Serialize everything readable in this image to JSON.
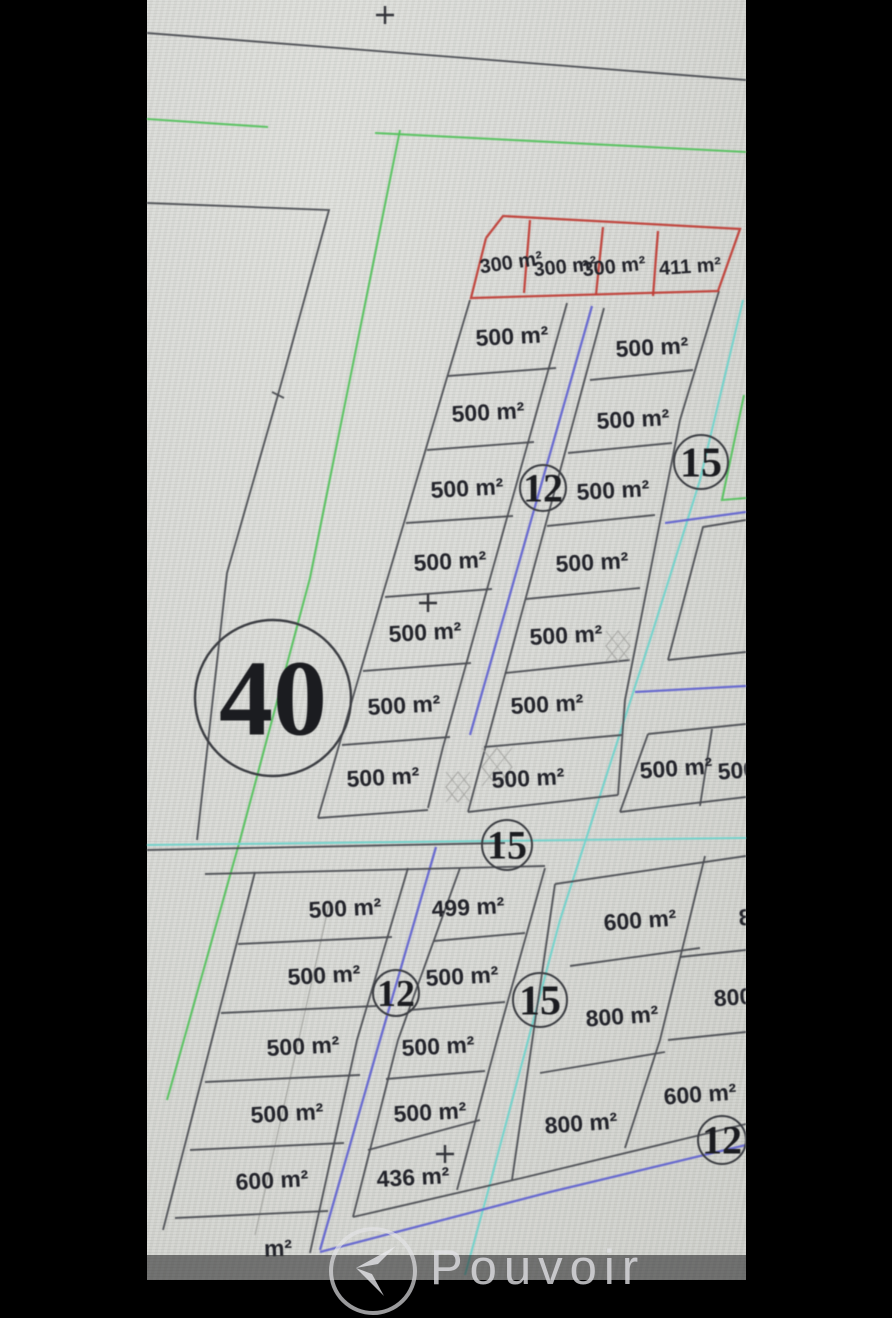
{
  "scene": {
    "width": 892,
    "height": 1280,
    "photo_left": 147,
    "photo_right": 746
  },
  "colors": {
    "screen_bg": "#d6d7d3",
    "line_dark": "#4b4d52",
    "line_red": "#bf3d35",
    "line_green": "#54c15c",
    "line_blue": "#6163cf",
    "line_teal": "#6fd3cb",
    "line_faint": "#a4a5a1",
    "label_ink": "#23242b",
    "circle_stroke": "#3c3e43",
    "watermark_bar": "rgba(32,32,35,0.55)",
    "watermark_ink": "rgba(226,226,229,0.78)"
  },
  "watermark": {
    "brand": "Pouvoir"
  },
  "plot_labels": [
    {
      "text": "300 m²",
      "x": 511,
      "y": 262,
      "rot": -8,
      "size": 20
    },
    {
      "text": "300 m²",
      "x": 565,
      "y": 266,
      "rot": -6,
      "size": 20
    },
    {
      "text": "300 m²",
      "x": 614,
      "y": 266,
      "rot": -6,
      "size": 20
    },
    {
      "text": "411 m²",
      "x": 690,
      "y": 266,
      "rot": -4,
      "size": 20
    },
    {
      "text": "500 m²",
      "x": 512,
      "y": 336,
      "rot": -3,
      "size": 23
    },
    {
      "text": "500 m²",
      "x": 488,
      "y": 412,
      "rot": -3,
      "size": 23
    },
    {
      "text": "500 m²",
      "x": 467,
      "y": 488,
      "rot": -3,
      "size": 23
    },
    {
      "text": "500 m²",
      "x": 450,
      "y": 561,
      "rot": -3,
      "size": 23
    },
    {
      "text": "500 m²",
      "x": 425,
      "y": 632,
      "rot": -3,
      "size": 23
    },
    {
      "text": "500 m²",
      "x": 404,
      "y": 705,
      "rot": -3,
      "size": 23
    },
    {
      "text": "500 m²",
      "x": 383,
      "y": 777,
      "rot": -3,
      "size": 23
    },
    {
      "text": "500 m²",
      "x": 652,
      "y": 347,
      "rot": -3,
      "size": 23
    },
    {
      "text": "500 m²",
      "x": 633,
      "y": 419,
      "rot": -3,
      "size": 23
    },
    {
      "text": "500 m²",
      "x": 613,
      "y": 490,
      "rot": -3,
      "size": 23
    },
    {
      "text": "500 m²",
      "x": 592,
      "y": 562,
      "rot": -3,
      "size": 23
    },
    {
      "text": "500 m²",
      "x": 566,
      "y": 635,
      "rot": -3,
      "size": 23
    },
    {
      "text": "500 m²",
      "x": 547,
      "y": 704,
      "rot": -3,
      "size": 23
    },
    {
      "text": "500 m²",
      "x": 528,
      "y": 778,
      "rot": -3,
      "size": 23
    },
    {
      "text": "500 m²",
      "x": 676,
      "y": 768,
      "rot": -4,
      "size": 23
    },
    {
      "text": "500 m²",
      "x": 754,
      "y": 769,
      "rot": -4,
      "size": 23
    },
    {
      "text": "500 m²",
      "x": 345,
      "y": 908,
      "rot": -3,
      "size": 23
    },
    {
      "text": "500 m²",
      "x": 324,
      "y": 975,
      "rot": -3,
      "size": 23
    },
    {
      "text": "500 m²",
      "x": 303,
      "y": 1046,
      "rot": -3,
      "size": 23
    },
    {
      "text": "500 m²",
      "x": 287,
      "y": 1113,
      "rot": -3,
      "size": 23
    },
    {
      "text": "600 m²",
      "x": 272,
      "y": 1180,
      "rot": -3,
      "size": 23
    },
    {
      "text": "m²",
      "x": 278,
      "y": 1248,
      "rot": -2,
      "size": 23
    },
    {
      "text": "499 m²",
      "x": 468,
      "y": 907,
      "rot": -3,
      "size": 23
    },
    {
      "text": "500 m²",
      "x": 462,
      "y": 976,
      "rot": -3,
      "size": 23
    },
    {
      "text": "500 m²",
      "x": 438,
      "y": 1046,
      "rot": -3,
      "size": 23
    },
    {
      "text": "500 m²",
      "x": 430,
      "y": 1112,
      "rot": -3,
      "size": 23
    },
    {
      "text": "436 m²",
      "x": 413,
      "y": 1177,
      "rot": -3,
      "size": 23
    },
    {
      "text": "600 m²",
      "x": 640,
      "y": 920,
      "rot": -4,
      "size": 23
    },
    {
      "text": "800 m²",
      "x": 622,
      "y": 1016,
      "rot": -4,
      "size": 23
    },
    {
      "text": "800 m²",
      "x": 581,
      "y": 1123,
      "rot": -4,
      "size": 23
    },
    {
      "text": "800 m²",
      "x": 775,
      "y": 915,
      "rot": -4,
      "size": 23
    },
    {
      "text": "800",
      "x": 733,
      "y": 997,
      "rot": -4,
      "size": 23
    },
    {
      "text": "600 m²",
      "x": 700,
      "y": 1094,
      "rot": -4,
      "size": 23
    }
  ],
  "road_circles": [
    {
      "num": "40",
      "x": 273,
      "y": 698,
      "rad": 78,
      "fs": 108
    },
    {
      "num": "12",
      "x": 543,
      "y": 488,
      "rad": 23,
      "fs": 40
    },
    {
      "num": "15",
      "x": 701,
      "y": 462,
      "rad": 27,
      "fs": 42
    },
    {
      "num": "15",
      "x": 507,
      "y": 845,
      "rad": 25,
      "fs": 40
    },
    {
      "num": "12",
      "x": 396,
      "y": 993,
      "rad": 23,
      "fs": 38
    },
    {
      "num": "15",
      "x": 540,
      "y": 1000,
      "rad": 27,
      "fs": 42
    },
    {
      "num": "12",
      "x": 722,
      "y": 1140,
      "rad": 24,
      "fs": 40
    }
  ],
  "crosshairs": [
    {
      "x": 385,
      "y": 15
    },
    {
      "x": 428,
      "y": 603
    },
    {
      "x": 445,
      "y": 1154
    }
  ],
  "diamond_marks": [
    {
      "x": 497,
      "y": 767,
      "w": 30,
      "h": 38
    },
    {
      "x": 458,
      "y": 787,
      "w": 24,
      "h": 30
    },
    {
      "x": 618,
      "y": 646,
      "w": 24,
      "h": 30
    }
  ],
  "lines": {
    "dark": [
      [
        147,
        33,
        746,
        80
      ],
      [
        147,
        203,
        329,
        210,
        278,
        395,
        227,
        573,
        197,
        840
      ],
      [
        272,
        392,
        284,
        398
      ],
      [
        470,
        300,
        382,
        597,
        318,
        818
      ],
      [
        318,
        818,
        428,
        810
      ],
      [
        567,
        303,
        443,
        747,
        428,
        808
      ],
      [
        604,
        308,
        468,
        812
      ],
      [
        719,
        291,
        680,
        420,
        625,
        700,
        618,
        795
      ],
      [
        468,
        812,
        618,
        795
      ],
      [
        448,
        376,
        556,
        368
      ],
      [
        427,
        450,
        534,
        442
      ],
      [
        406,
        523,
        513,
        516
      ],
      [
        385,
        597,
        492,
        589
      ],
      [
        363,
        671,
        471,
        663
      ],
      [
        342,
        745,
        450,
        737
      ],
      [
        590,
        380,
        693,
        370
      ],
      [
        568,
        453,
        672,
        443
      ],
      [
        547,
        526,
        655,
        515
      ],
      [
        526,
        599,
        640,
        588
      ],
      [
        505,
        673,
        630,
        660
      ],
      [
        484,
        747,
        622,
        735
      ],
      [
        746,
        520,
        703,
        527,
        668,
        660
      ],
      [
        668,
        660,
        746,
        652
      ],
      [
        648,
        734,
        746,
        724
      ],
      [
        648,
        734,
        620,
        812
      ],
      [
        620,
        812,
        746,
        797
      ],
      [
        712,
        729,
        700,
        806
      ],
      [
        147,
        850,
        505,
        843
      ],
      [
        205,
        874,
        545,
        866
      ],
      [
        555,
        884,
        746,
        856
      ],
      [
        255,
        872,
        163,
        1230
      ],
      [
        408,
        868,
        357,
        1040,
        310,
        1253
      ],
      [
        238,
        944,
        392,
        937
      ],
      [
        221,
        1013,
        376,
        1006
      ],
      [
        205,
        1082,
        360,
        1075
      ],
      [
        190,
        1150,
        344,
        1143
      ],
      [
        175,
        1218,
        328,
        1211
      ],
      [
        460,
        868,
        398,
        1040,
        353,
        1217
      ],
      [
        545,
        868,
        497,
        1040,
        457,
        1190
      ],
      [
        434,
        941,
        525,
        933
      ],
      [
        410,
        1010,
        505,
        1002
      ],
      [
        386,
        1079,
        485,
        1071
      ],
      [
        368,
        1150,
        480,
        1120
      ],
      [
        353,
        1217,
        522,
        1178,
        746,
        1124
      ],
      [
        555,
        884,
        512,
        1180
      ],
      [
        705,
        856,
        660,
        1040,
        625,
        1148
      ],
      [
        570,
        966,
        700,
        948
      ],
      [
        540,
        1073,
        665,
        1052
      ],
      [
        680,
        957,
        746,
        950
      ],
      [
        668,
        1040,
        746,
        1032
      ]
    ],
    "red": [
      [
        486,
        238,
        503,
        216,
        740,
        229,
        718,
        291,
        471,
        298,
        486,
        238
      ],
      [
        530,
        220,
        524,
        293
      ],
      [
        603,
        227,
        596,
        295
      ],
      [
        658,
        231,
        653,
        296
      ]
    ],
    "green": [
      [
        147,
        119,
        268,
        127
      ],
      [
        375,
        133,
        746,
        152
      ],
      [
        400,
        130,
        310,
        578,
        240,
        840,
        167,
        1100
      ],
      [
        744,
        395,
        722,
        500,
        746,
        498
      ]
    ],
    "blue": [
      [
        592,
        306,
        470,
        735
      ],
      [
        665,
        523,
        746,
        512
      ],
      [
        635,
        692,
        746,
        686
      ],
      [
        436,
        847,
        380,
        1040,
        320,
        1250
      ],
      [
        320,
        1252,
        550,
        1192,
        746,
        1145
      ]
    ],
    "teal": [
      [
        743,
        300,
        700,
        480,
        650,
        640,
        560,
        920,
        487,
        1195,
        465,
        1275
      ],
      [
        147,
        845,
        746,
        838
      ]
    ],
    "faint": [
      [
        330,
        900,
        255,
        1235
      ]
    ]
  }
}
